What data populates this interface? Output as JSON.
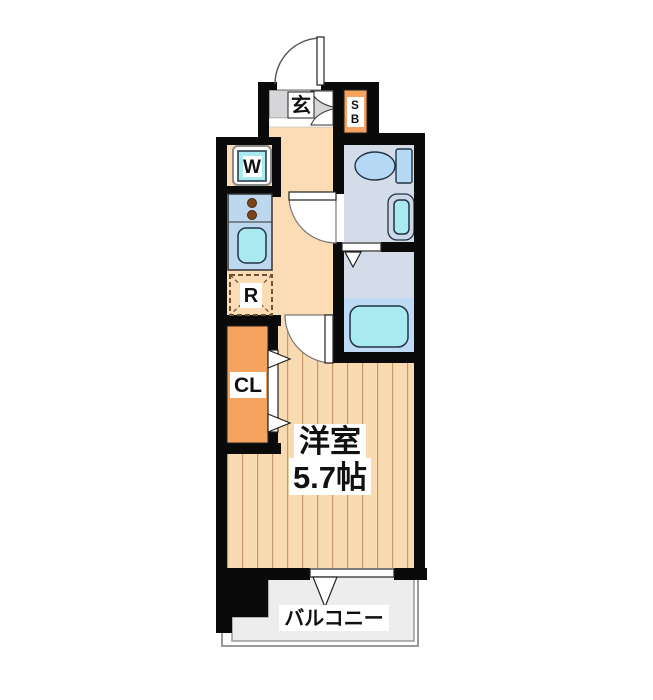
{
  "plan": {
    "type": "floor-plan",
    "labels": {
      "entrance": "玄",
      "shoe_box": [
        "S",
        "B"
      ],
      "washer": "W",
      "refrigerator": "R",
      "closet": "CL",
      "room_name": "洋室",
      "room_size": "5.7帖",
      "balcony": "バルコニー"
    },
    "colors": {
      "wall": "#0a0a0a",
      "floor": "#f8dbb0",
      "plank_line": "#c49a6a",
      "hallway": "#fcdcb4",
      "genkan_tile": "#d6d6d8",
      "orange": "#f5a35f",
      "counter_blue": "#bdd7ee",
      "fixture_cyan": "#a9e9f0",
      "wet_gray": "#d5dce9",
      "tub_blue": "#bedaf4",
      "balcony_gray": "#ededed",
      "line_gray": "#999999",
      "label_text": "#111111",
      "fridge_dash": "#6e5136",
      "burner_brown": "#7d4517",
      "fix_blue": "#b5d8f4"
    }
  }
}
